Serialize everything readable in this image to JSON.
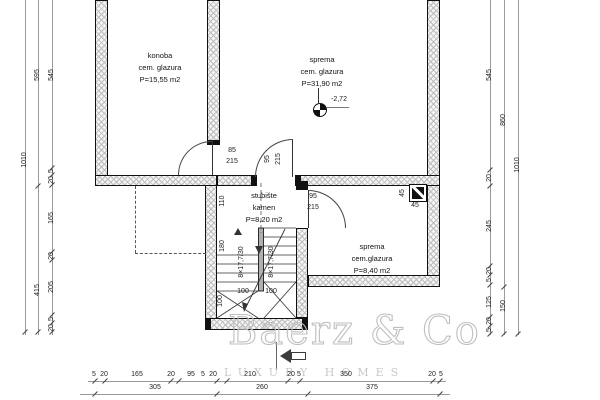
{
  "rooms": [
    {
      "name": "konoba",
      "finish": "cem. glazura",
      "area": "P=15,55 m2"
    },
    {
      "name": "sprema",
      "finish": "cem. glazura",
      "area": "P=31,90 m2"
    },
    {
      "name": "stubište",
      "finish": "kamen",
      "area": "P=8,20 m2"
    },
    {
      "name": "sprema",
      "finish": "cem.glazura",
      "area": "P=8,40 m2"
    }
  ],
  "doors": [
    {
      "width": "85",
      "height": "215"
    },
    {
      "width": "95",
      "height": "215"
    },
    {
      "width": "95",
      "height": "215"
    }
  ],
  "elevation_label": "-2,72",
  "chimney": {
    "side": "45",
    "front": "45"
  },
  "stairs": {
    "flight_label_1": "8×17,7/30",
    "flight_label_2": "8×17,7/30",
    "width_top": "110",
    "width_mid": "180",
    "winder_1": "100",
    "winder_2": "100",
    "winder_3": "100"
  },
  "dims": {
    "left_outer": [
      "1010"
    ],
    "left_mid": [
      "595",
      "415"
    ],
    "left_inner": [
      "545",
      "5",
      "20",
      "165",
      "20",
      "205",
      "5",
      "20"
    ],
    "right_inner": [
      "545",
      "20",
      "245",
      "20",
      "5",
      "125",
      "20",
      "5"
    ],
    "right_mid": [
      "860",
      "150"
    ],
    "right_outer": [
      "1010"
    ],
    "bottom_inner": [
      "5",
      "20",
      "165",
      "20",
      "95",
      "5",
      "20",
      "210",
      "20",
      "5",
      "350",
      "20",
      "5"
    ],
    "bottom_mid": [
      "305",
      "260",
      "375"
    ]
  },
  "watermark": {
    "brand": "Baerz & Co",
    "tagline": "LUXURY HOMES"
  },
  "colors": {
    "wall_line": "#111111",
    "hatch": "#bdbdbd",
    "dim_text": "#222222",
    "watermark": "#bfbfbf"
  }
}
